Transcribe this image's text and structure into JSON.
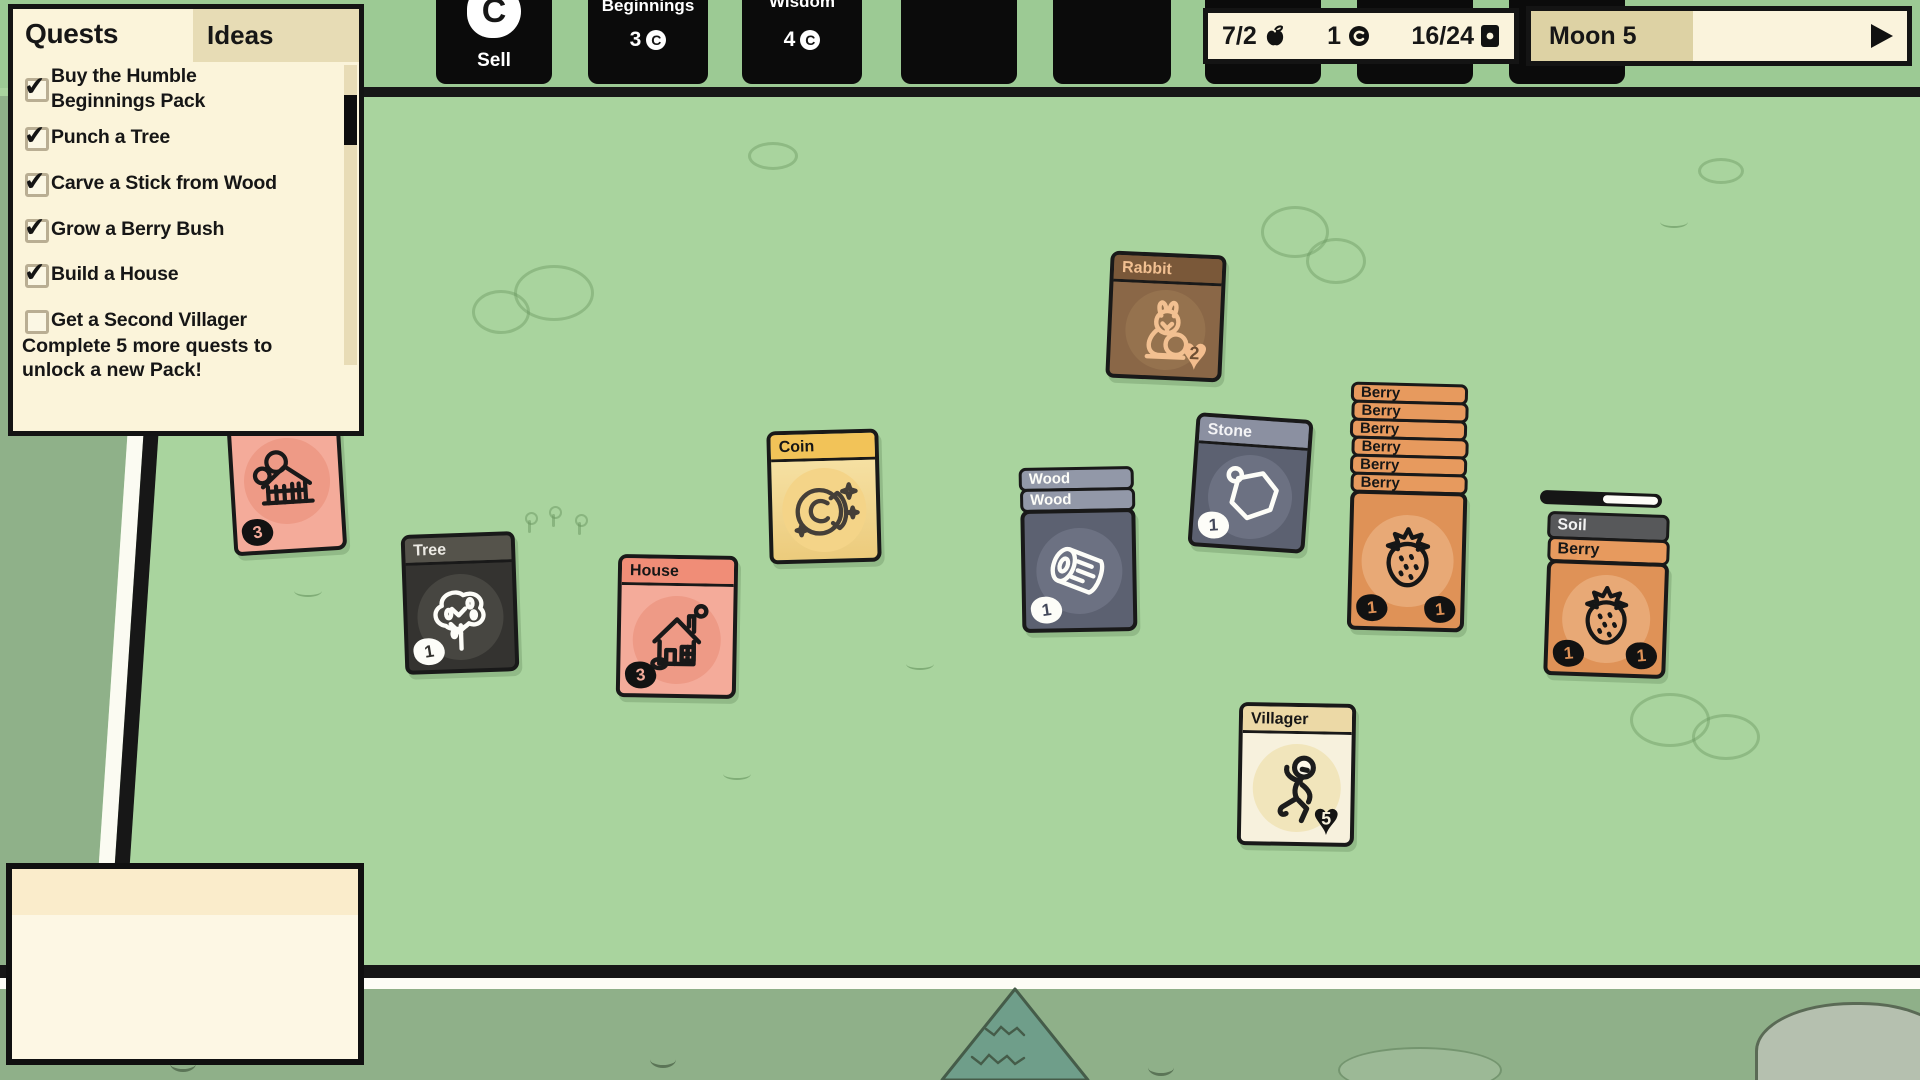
{
  "quests_panel": {
    "tab_quests": "Quests",
    "tab_ideas": "Ideas",
    "quests": [
      {
        "line1": "Buy the Humble",
        "line2": "Beginnings Pack",
        "checked": true
      },
      {
        "line1": "Punch a Tree",
        "checked": true
      },
      {
        "line1": "Carve a Stick from Wood",
        "checked": true
      },
      {
        "line1": "Grow a Berry Bush",
        "checked": true
      },
      {
        "line1": "Build a House",
        "checked": true
      },
      {
        "line1": "Get a Second Villager",
        "checked": false
      }
    ],
    "check_glyph": "✔",
    "footer_line1": "Complete 5 more quests to",
    "footer_line2": "unlock a new Pack!"
  },
  "top_bar": {
    "sell_label": "Sell",
    "sell_coin_glyph": "C",
    "pack1_title": "Beginnings",
    "pack1_price": "3",
    "pack2_title": "Wisdom",
    "pack2_price": "4",
    "coin_glyph": "C"
  },
  "status_bar": {
    "food": "7/2",
    "coins": "1",
    "cards": "16/24"
  },
  "moon_panel": {
    "label": "Moon 5",
    "progress_percent": 43,
    "play_glyph": "play"
  },
  "board": {
    "rabbit": {
      "title": "Rabbit",
      "heart_value": "2"
    },
    "berry_stack": {
      "strips": [
        "Berry",
        "Berry",
        "Berry",
        "Berry",
        "Berry",
        "Berry"
      ],
      "badge_left": "1",
      "badge_right": "1"
    },
    "stone": {
      "title": "Stone",
      "badge": "1"
    },
    "wood_stack": {
      "strips": [
        "Wood",
        "Wood"
      ],
      "badge": "1"
    },
    "coin": {
      "title": "Coin"
    },
    "tree": {
      "title": "Tree",
      "badge": "1"
    },
    "house": {
      "title": "House",
      "badge": "3"
    },
    "soil_stack": {
      "title_top": "Soil",
      "title_mid": "Berry",
      "badge_left": "1",
      "badge_right": "1",
      "growth_progress_percent": 45
    },
    "villager": {
      "title": "Villager",
      "heart_value": "5"
    },
    "partial_card": {
      "badge": "3"
    }
  },
  "colors": {
    "board_green": "#a9d49e",
    "outer_green": "#8fb189",
    "panel_cream": "#faf3dc",
    "moon_elapsed_tan": "#ddd2a4",
    "berry_orange": "#df9257",
    "slate_grey": "#5c6171",
    "house_pink": "#f4ab9a",
    "tree_dark": "#343330",
    "rabbit_brown": "#8a6747",
    "coin_gold": "#f2c358",
    "villager_cream": "#f7f1dd"
  }
}
